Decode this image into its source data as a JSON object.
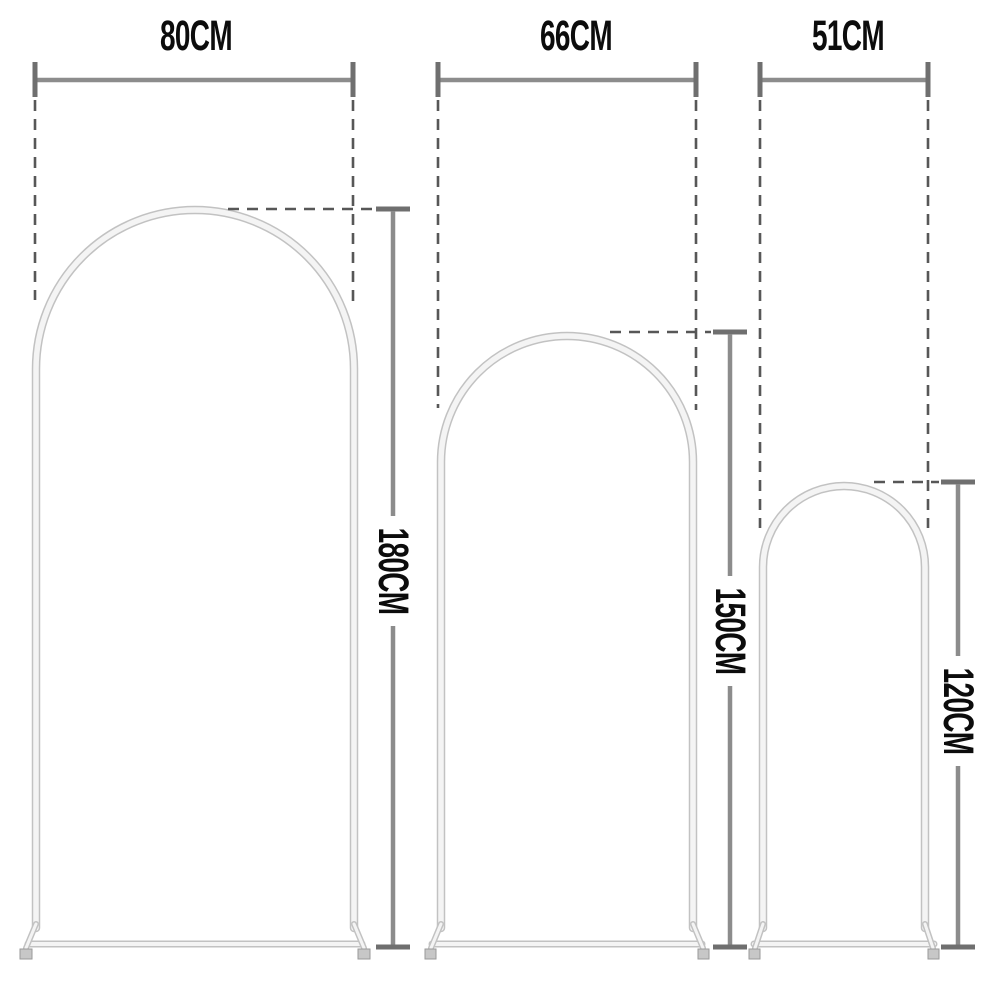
{
  "diagram": {
    "description": "Three arched backdrop stand frames with width and height dimension annotations",
    "background": "#ffffff",
    "arches": [
      {
        "name": "large-arch",
        "width_label": "80CM",
        "height_label": "180CM"
      },
      {
        "name": "medium-arch",
        "width_label": "66CM",
        "height_label": "150CM"
      },
      {
        "name": "small-arch",
        "width_label": "51CM",
        "height_label": "120CM"
      }
    ],
    "colors": {
      "frame_fill": "#f4f4f4",
      "frame_edge": "#c2c2c2",
      "dimension_line": "#8c8c8c",
      "tick": "#6f6f6f",
      "dashed_line": "#575757",
      "label_text": "#0c0c0c",
      "background": "#ffffff"
    }
  }
}
